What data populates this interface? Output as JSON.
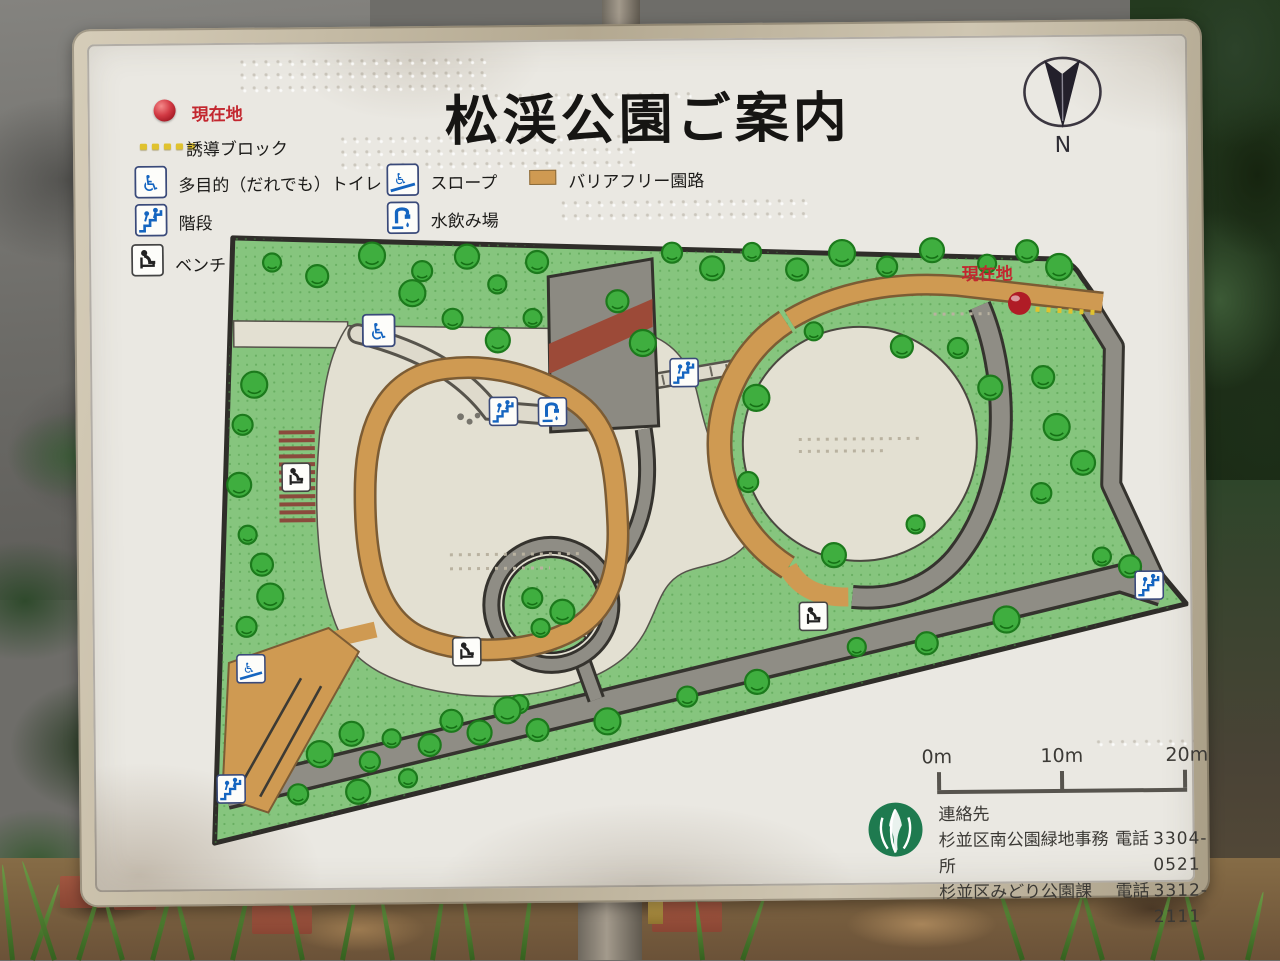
{
  "sign": {
    "title": "松渓公園ご案内",
    "compass": {
      "label": "N"
    },
    "legend": {
      "items": [
        {
          "id": "current-location",
          "icon": "red-dot-icon",
          "label": "現在地"
        },
        {
          "id": "guidance-block",
          "icon": "yellow-dots-icon",
          "label": "誘導ブロック"
        },
        {
          "id": "accessible-toilet",
          "icon": "wheelchair-icon",
          "label": "多目的（だれでも）トイレ"
        },
        {
          "id": "slope",
          "icon": "wheelchair-slope-icon",
          "label": "スロープ"
        },
        {
          "id": "barrier-free-path",
          "icon": "tan-swatch-icon",
          "label": "バリアフリー園路"
        },
        {
          "id": "stairs",
          "icon": "stairs-icon",
          "label": "階段"
        },
        {
          "id": "water-fountain",
          "icon": "water-fountain-icon",
          "label": "水飲み場"
        },
        {
          "id": "bench",
          "icon": "bench-icon",
          "label": "ベンチ"
        }
      ]
    },
    "map_labels": {
      "current_location": "現在地"
    },
    "scale_bar": {
      "ticks": [
        "0m",
        "10m",
        "20m"
      ]
    },
    "contact": {
      "heading": "連絡先",
      "rows": [
        {
          "name": "杉並区南公園緑地事務所",
          "tel_label": "電話",
          "number": "3304-0521"
        },
        {
          "name": "杉並区みどり公園課",
          "tel_label": "電話",
          "number": "3312-2111"
        }
      ]
    },
    "colors": {
      "accent_red": "#c3272f",
      "legend_blue": "#1565c0",
      "barrier_free_tan": "#cf9a52",
      "park_green": "#86c57e",
      "tree_green": "#3fae3f",
      "path_gray": "#8f8d85",
      "plaza_cream": "#e3e0d2",
      "guidance_yellow": "#e0c22e",
      "logo_green": "#1e7a4f",
      "frame_beige": "#c2b79f",
      "face_white": "#eae8e2"
    }
  }
}
